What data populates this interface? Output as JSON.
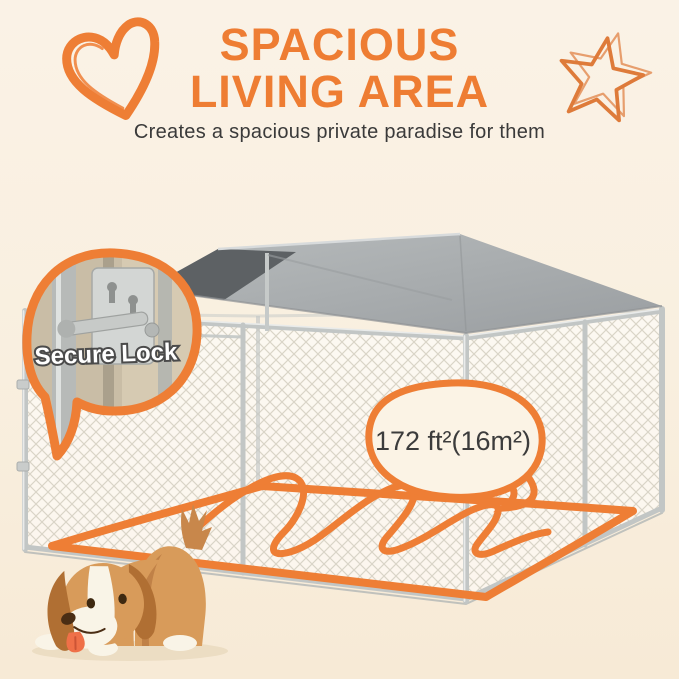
{
  "header": {
    "title_line1": "SPACIOUS",
    "title_line2": "LIVING AREA",
    "subtitle": "Creates a spacious private paradise for them"
  },
  "callouts": {
    "lock": {
      "label": "Secure Lock"
    },
    "area": {
      "label": "172 ft²(16m²)"
    }
  },
  "icons": {
    "heart": "heart-doodle-icon",
    "star": "star-doodle-icon"
  },
  "colors": {
    "background": "#FAF1E4",
    "accent_orange": "#EE7E35",
    "title_orange": "#EE7D33",
    "text_dark": "#3C3C3C",
    "bubble_fill": "#FBF3E5",
    "roof_gray": "#A5A9AB",
    "roof_underside": "#5D6164",
    "frame_gray": "#C2C6C5",
    "dog_tan": "#D89B5A",
    "dog_dark_tan": "#B06F33",
    "dog_white": "#F9F4E7",
    "tongue_orange": "#EF7048"
  }
}
